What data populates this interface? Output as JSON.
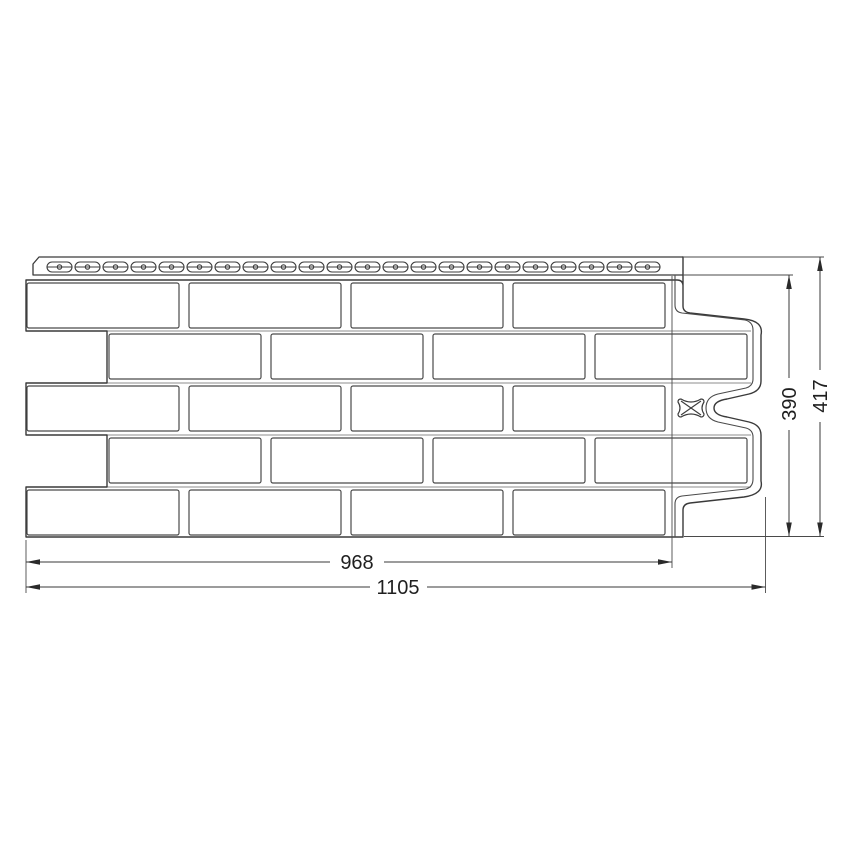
{
  "drawing": {
    "title": "facade-panel-technical-drawing",
    "line_color": "#3a3a3a",
    "brick_line_color": "#4a4a4a",
    "mortar_line_color": "#8c8c8c",
    "background": "#ffffff",
    "dimensions": {
      "useful_width": "968",
      "total_width": "1105",
      "useful_height": "390",
      "total_height": "417"
    },
    "panel": {
      "row_boundaries": [
        331,
        383,
        435,
        487
      ],
      "row_boundary_x1": 27,
      "row_boundary_x2": 751,
      "brick_rows": [
        {
          "y": 283,
          "h": 45,
          "w": 152,
          "xs": [
            27,
            189,
            351,
            513
          ]
        },
        {
          "y": 334,
          "h": 45,
          "w": 152,
          "xs": [
            109,
            271,
            433,
            595
          ]
        },
        {
          "y": 386,
          "h": 45,
          "w": 152,
          "xs": [
            27,
            189,
            351,
            513
          ]
        },
        {
          "y": 438,
          "h": 45,
          "w": 152,
          "xs": [
            109,
            271,
            433,
            595
          ]
        },
        {
          "y": 490,
          "h": 45,
          "w": 152,
          "xs": [
            27,
            189,
            351,
            513
          ]
        }
      ],
      "nail_slots": {
        "count": 22,
        "x0": 47,
        "pitch": 28,
        "y": 262,
        "w": 25,
        "h": 10
      }
    }
  }
}
